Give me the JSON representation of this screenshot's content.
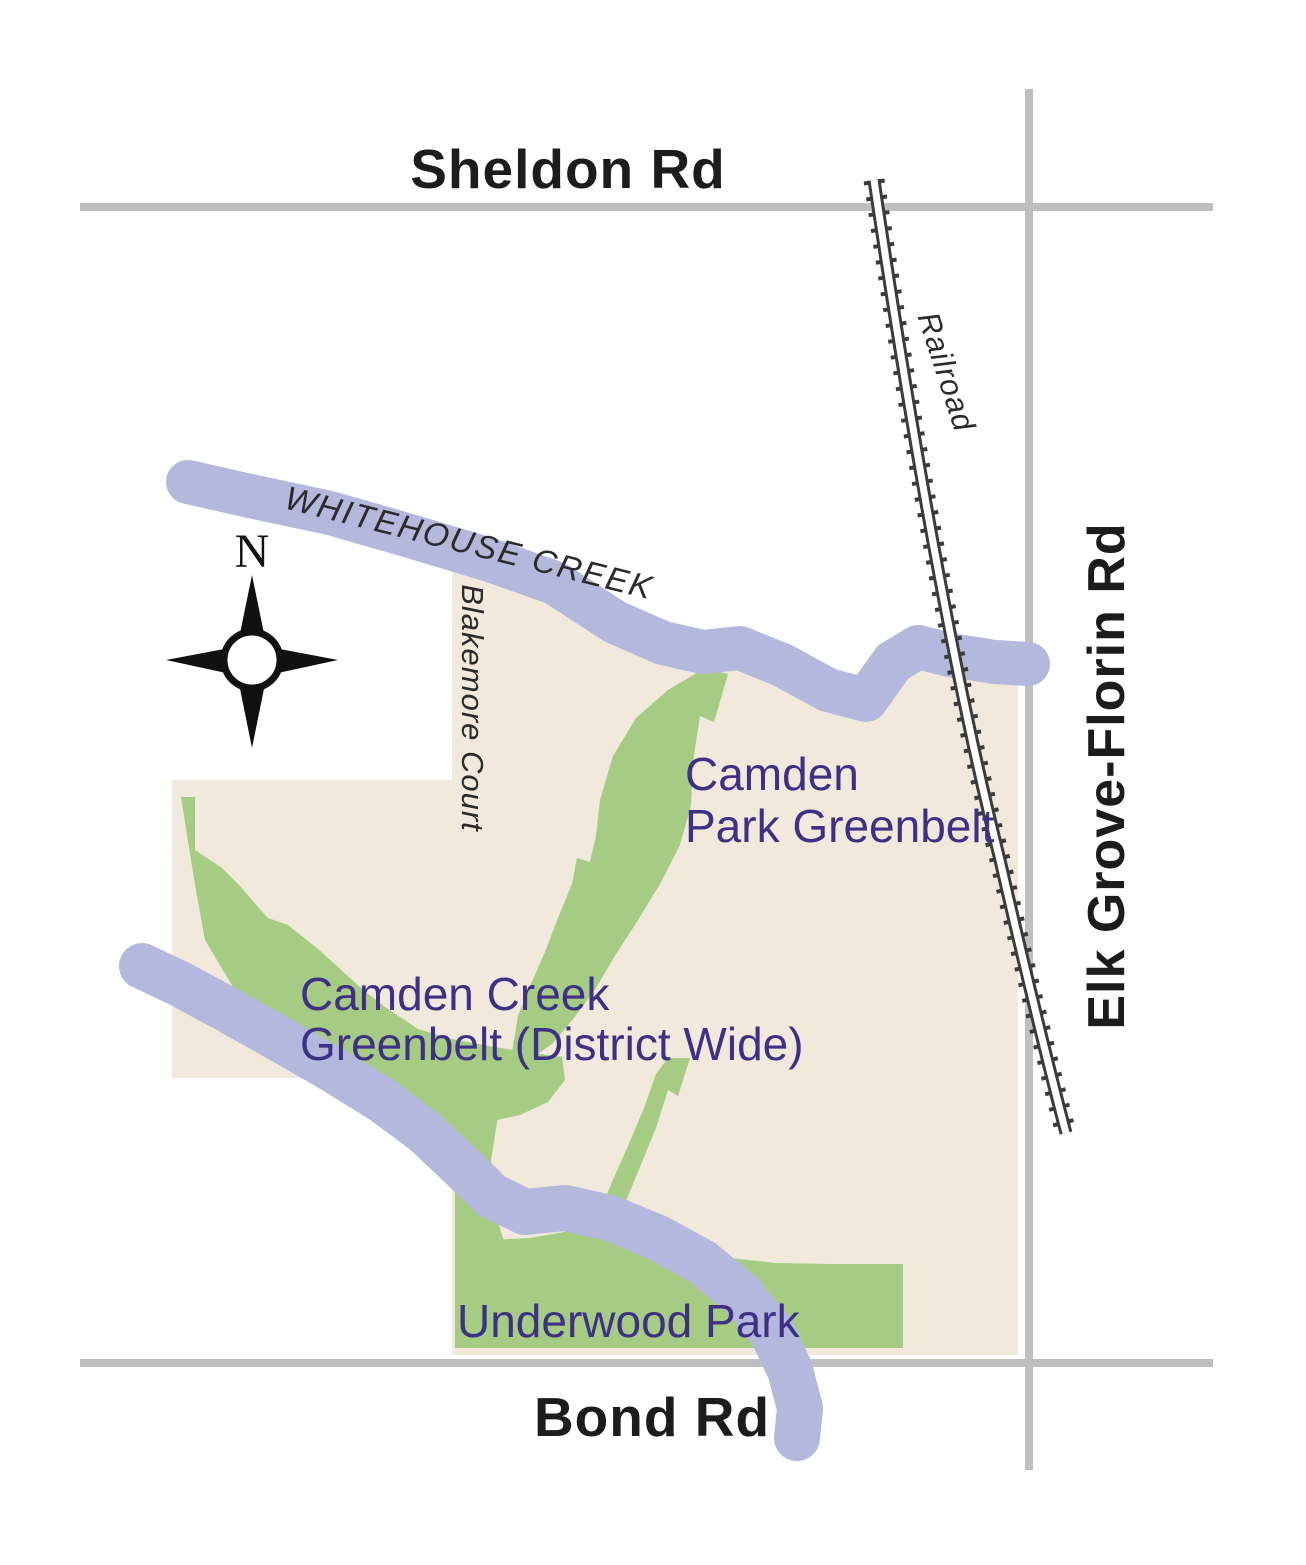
{
  "labels": {
    "sheldon_rd": "Sheldon Rd",
    "bond_rd": "Bond Rd",
    "elk_grove_florin_rd": "Elk Grove-Florin Rd",
    "blakemore_court": "Blakemore Court",
    "railroad": "Railroad",
    "whitehouse_creek": "WHITEHOUSE CREEK",
    "camden_park_greenbelt_line1": "Camden",
    "camden_park_greenbelt_line2": "Park Greenbelt",
    "camden_creek_greenbelt_line1": "Camden Creek",
    "camden_creek_greenbelt_line2": "Greenbelt  (District Wide)",
    "underwood_park": "Underwood Park"
  },
  "compass": {
    "north": "N"
  },
  "colors": {
    "background": "#ffffff",
    "district_beige": "#f0e9dc",
    "greenbelt_green": "#a5cc82",
    "creek_lavender": "#b4b8dc",
    "road_gray": "#bfbfbf",
    "railroad_dark": "#3b3b3b",
    "area_label_purple": "#3e3185",
    "road_label_black": "#1c1c1c"
  }
}
